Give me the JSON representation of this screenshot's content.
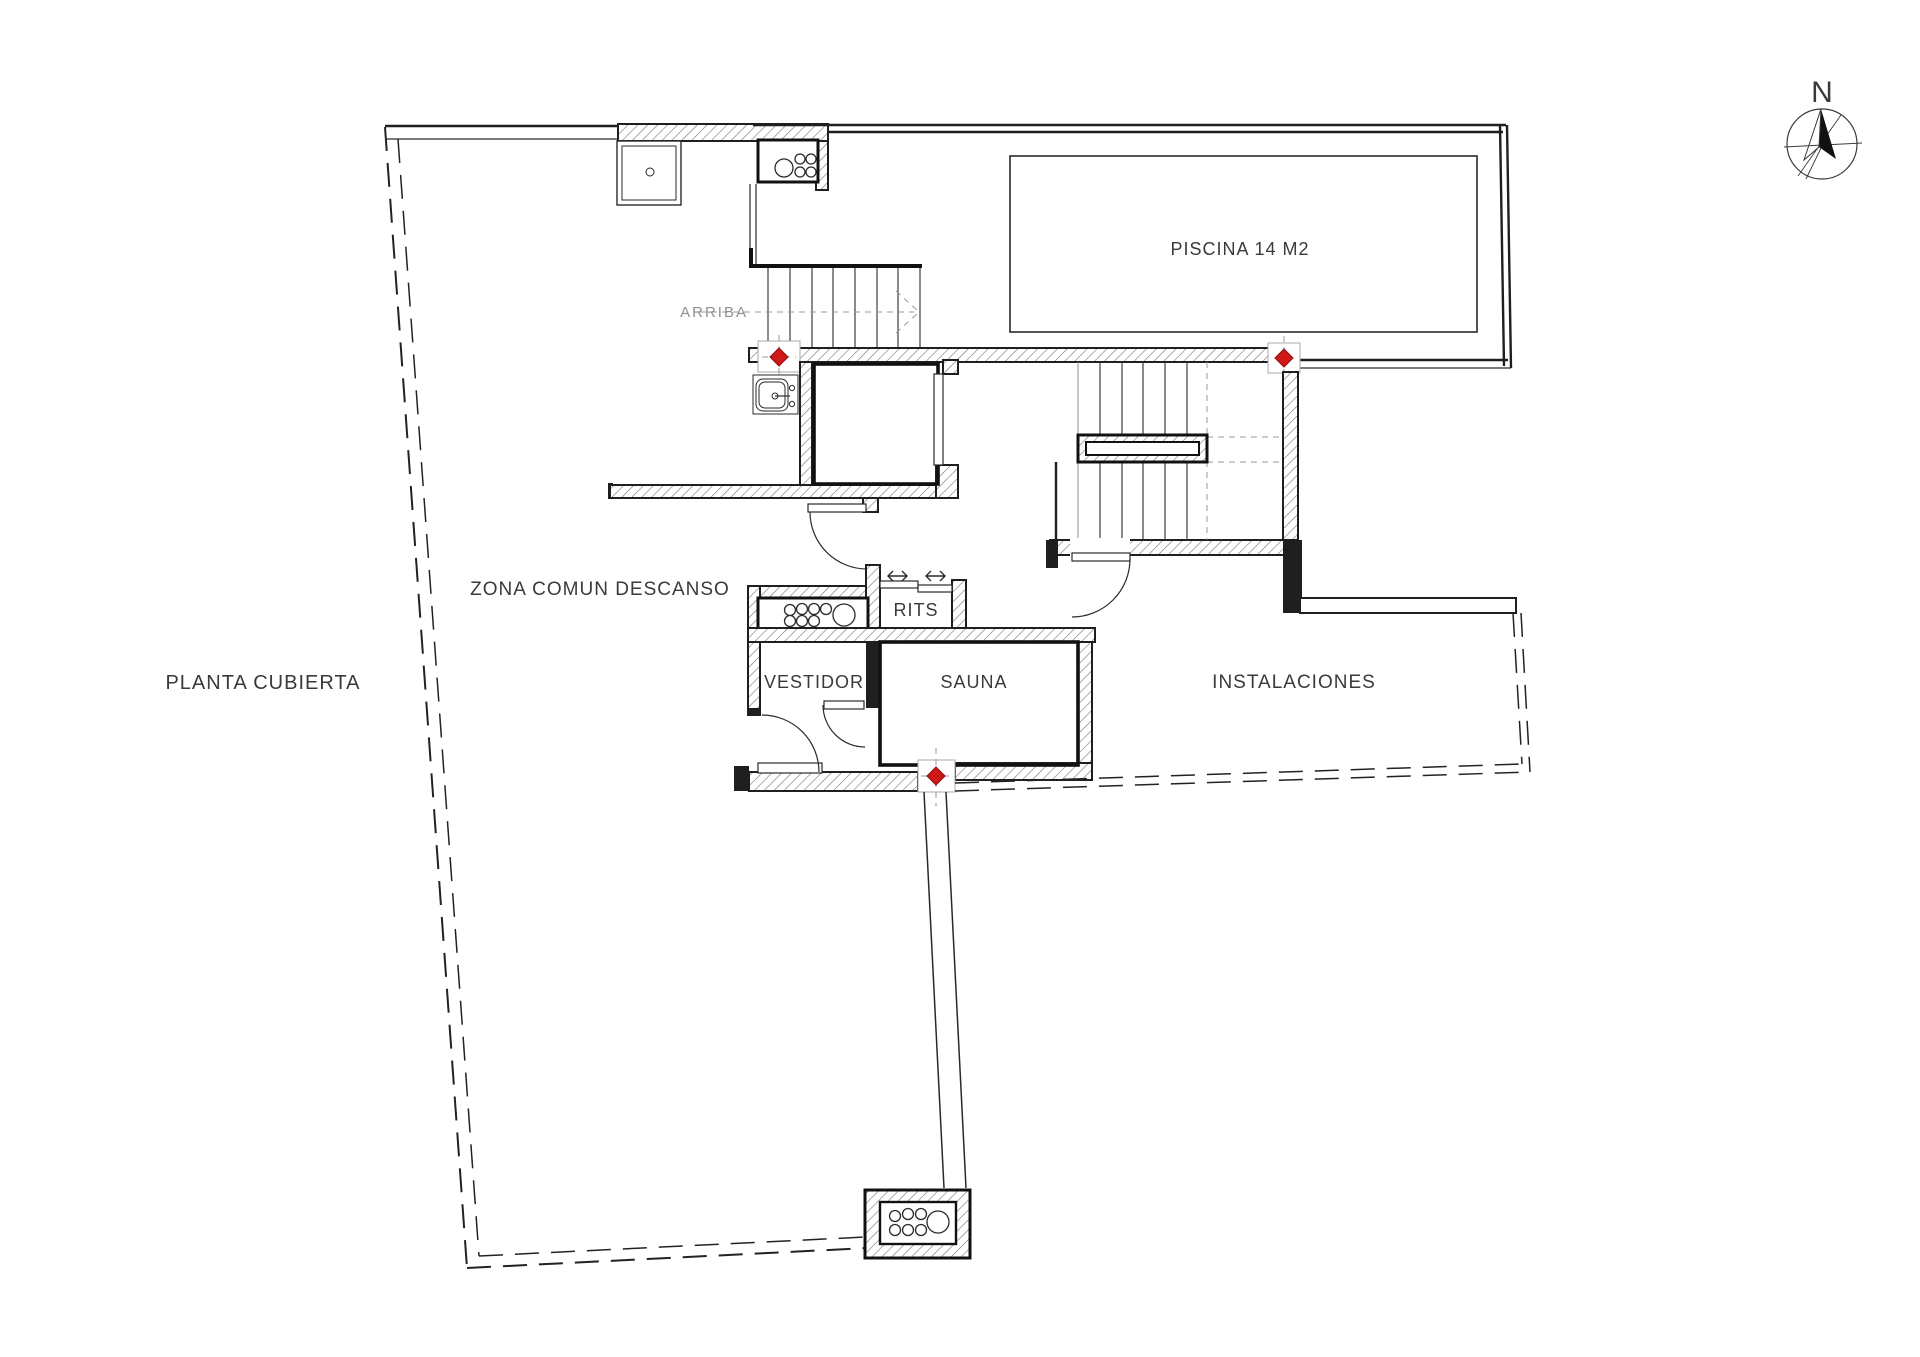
{
  "plan": {
    "title": "PLANTA CUBIERTA",
    "north_label": "N"
  },
  "rooms": {
    "zona_comun": "ZONA COMUN DESCANSO",
    "piscina": "PISCINA 14 M2",
    "rits": "RITS",
    "vestidor": "VESTIDOR",
    "sauna": "SAUNA",
    "instalaciones": "INSTALACIONES"
  },
  "annotations": {
    "stair_direction": "ARRIBA"
  },
  "colors": {
    "wall_line": "#1f1f1f",
    "hatch_line": "#777777",
    "text": "#3a3a3a",
    "muted_text": "#8f8f8f",
    "marker_red": "#d01818",
    "background": "#ffffff"
  }
}
